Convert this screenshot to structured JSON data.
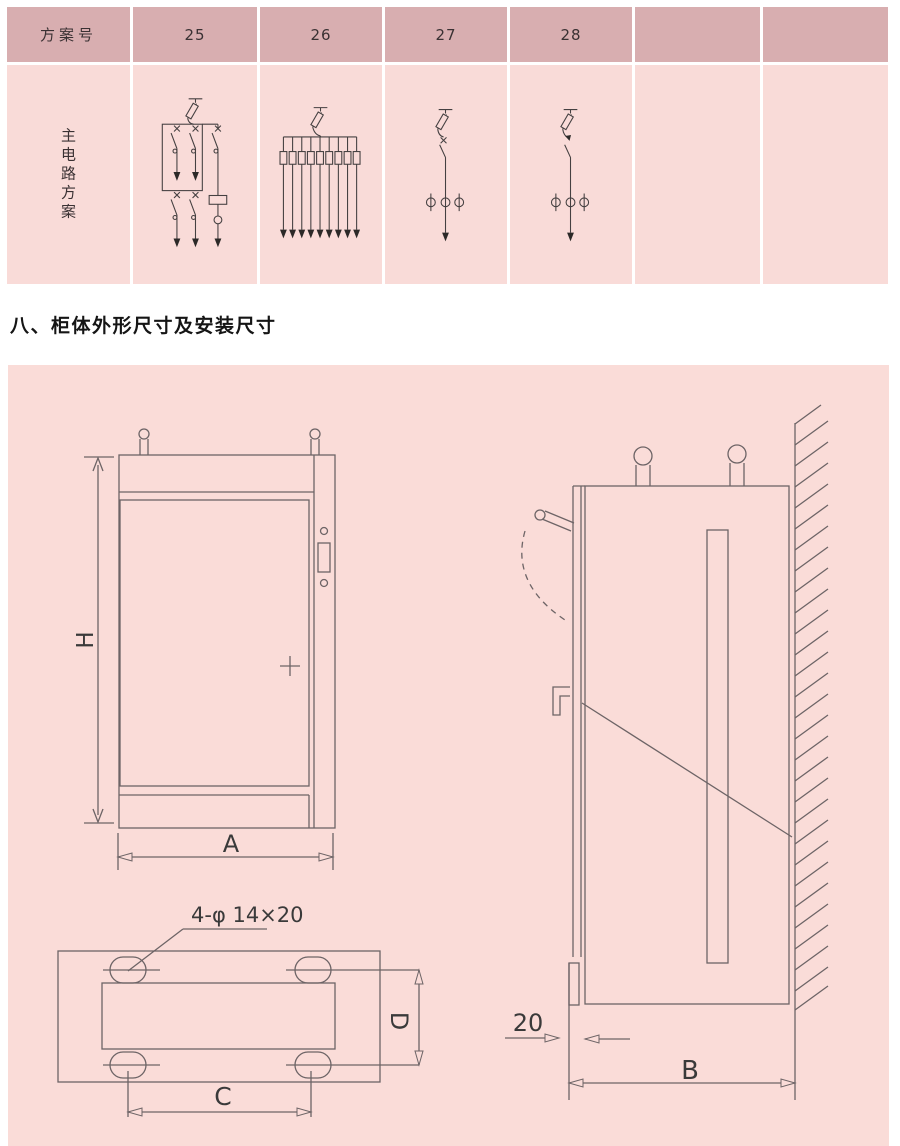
{
  "scheme_table": {
    "header_label": "方案号",
    "row_label": "主电路方案",
    "columns": [
      "25",
      "26",
      "27",
      "28",
      "",
      ""
    ],
    "colors": {
      "header_bg": "#d8aeb0",
      "body_bg": "#f9dbd8",
      "divider": "#ffffff"
    }
  },
  "section_heading": "八、柜体外形尺寸及安装尺寸",
  "drawing_panel": {
    "bg": "#fadcd8",
    "line_color": "#6d6466",
    "labels": {
      "height": "H",
      "width": "A",
      "depth": "B",
      "foot_width": "C",
      "foot_depth": "D",
      "wall_gap": "20",
      "mounting_holes": "4-φ 14×20"
    }
  }
}
